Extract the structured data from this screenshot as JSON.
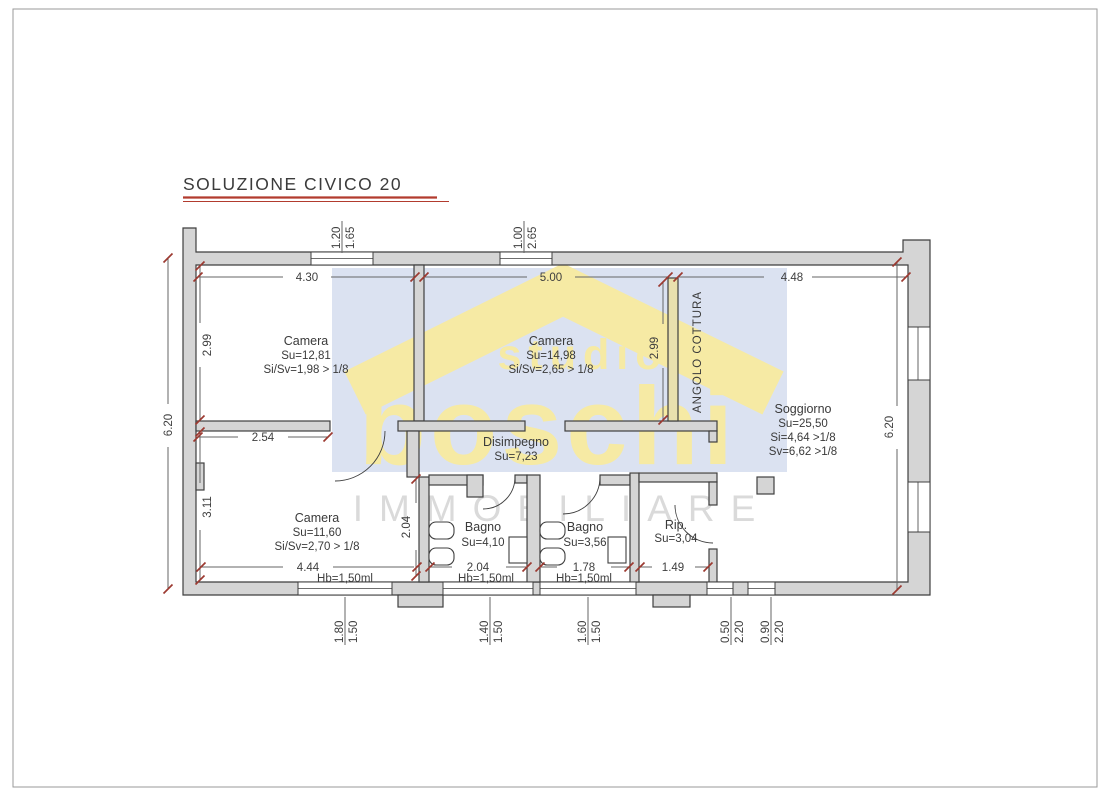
{
  "title": "SOLUZIONE CIVICO 20",
  "watermark": {
    "line1": "studio",
    "line2": "boschi",
    "line3": "IMMOBILIARE"
  },
  "rooms": {
    "camera1": {
      "name": "Camera",
      "area": "Su=12,81",
      "ratio": "Si/Sv=1,98 > 1/8"
    },
    "camera2": {
      "name": "Camera",
      "area": "Su=14,98",
      "ratio": "Si/Sv=2,65 > 1/8"
    },
    "soggiorno": {
      "name": "Soggiorno",
      "area": "Su=25,50",
      "si": "Si=4,64 >1/8",
      "sv": "Sv=6,62 >1/8"
    },
    "disimpegno": {
      "name": "Disimpegno",
      "area": "Su=7,23"
    },
    "camera3": {
      "name": "Camera",
      "area": "Su=11,60",
      "ratio": "Si/Sv=2,70 > 1/8"
    },
    "bagno1": {
      "name": "Bagno",
      "area": "Su=4,10"
    },
    "bagno2": {
      "name": "Bagno",
      "area": "Su=3,56"
    },
    "rip": {
      "name": "Rip.",
      "area": "Su=3,04"
    },
    "angolo_cottura": {
      "name": "ANGOLO COTTURA"
    }
  },
  "dimensions": {
    "top": {
      "c1": "4.30",
      "c2": "5.00",
      "c3": "4.48"
    },
    "top_windows": {
      "w1a": "1.20",
      "w1b": "1.65",
      "w2a": "1.00",
      "w2b": "2.65"
    },
    "left": {
      "total": "6.20",
      "upper": "2.99",
      "lower": "3.11"
    },
    "right": {
      "total": "6.20"
    },
    "middle": {
      "cottura": "2.99",
      "corridor": "2.54",
      "bagno1_h": "2.04"
    },
    "bottom": {
      "c1": "4.44",
      "c2": "2.04",
      "c3": "1.78",
      "c4": "1.49",
      "hb": "Hb=1,50ml"
    },
    "bottom_windows": {
      "w1a": "1.80",
      "w1b": "1.50",
      "w2a": "1.40",
      "w2b": "1.50",
      "w3a": "1.60",
      "w3b": "1.50",
      "w4a": "0.50",
      "w4b": "2.20",
      "w5a": "0.90",
      "w5b": "2.20"
    }
  },
  "colors": {
    "accent_red": "#b23b2e",
    "tick_red": "#9c3a31",
    "wall_fill": "#d5d5d5",
    "wall_tinted": "#e9e0ae",
    "line_dark": "#3f3f3f",
    "dim_line": "#666666",
    "text": "#3c3c3c",
    "wm_blue": "#dbe2f1",
    "wm_yellow": "#f6eaa4",
    "wm_gray": "#dadada"
  }
}
